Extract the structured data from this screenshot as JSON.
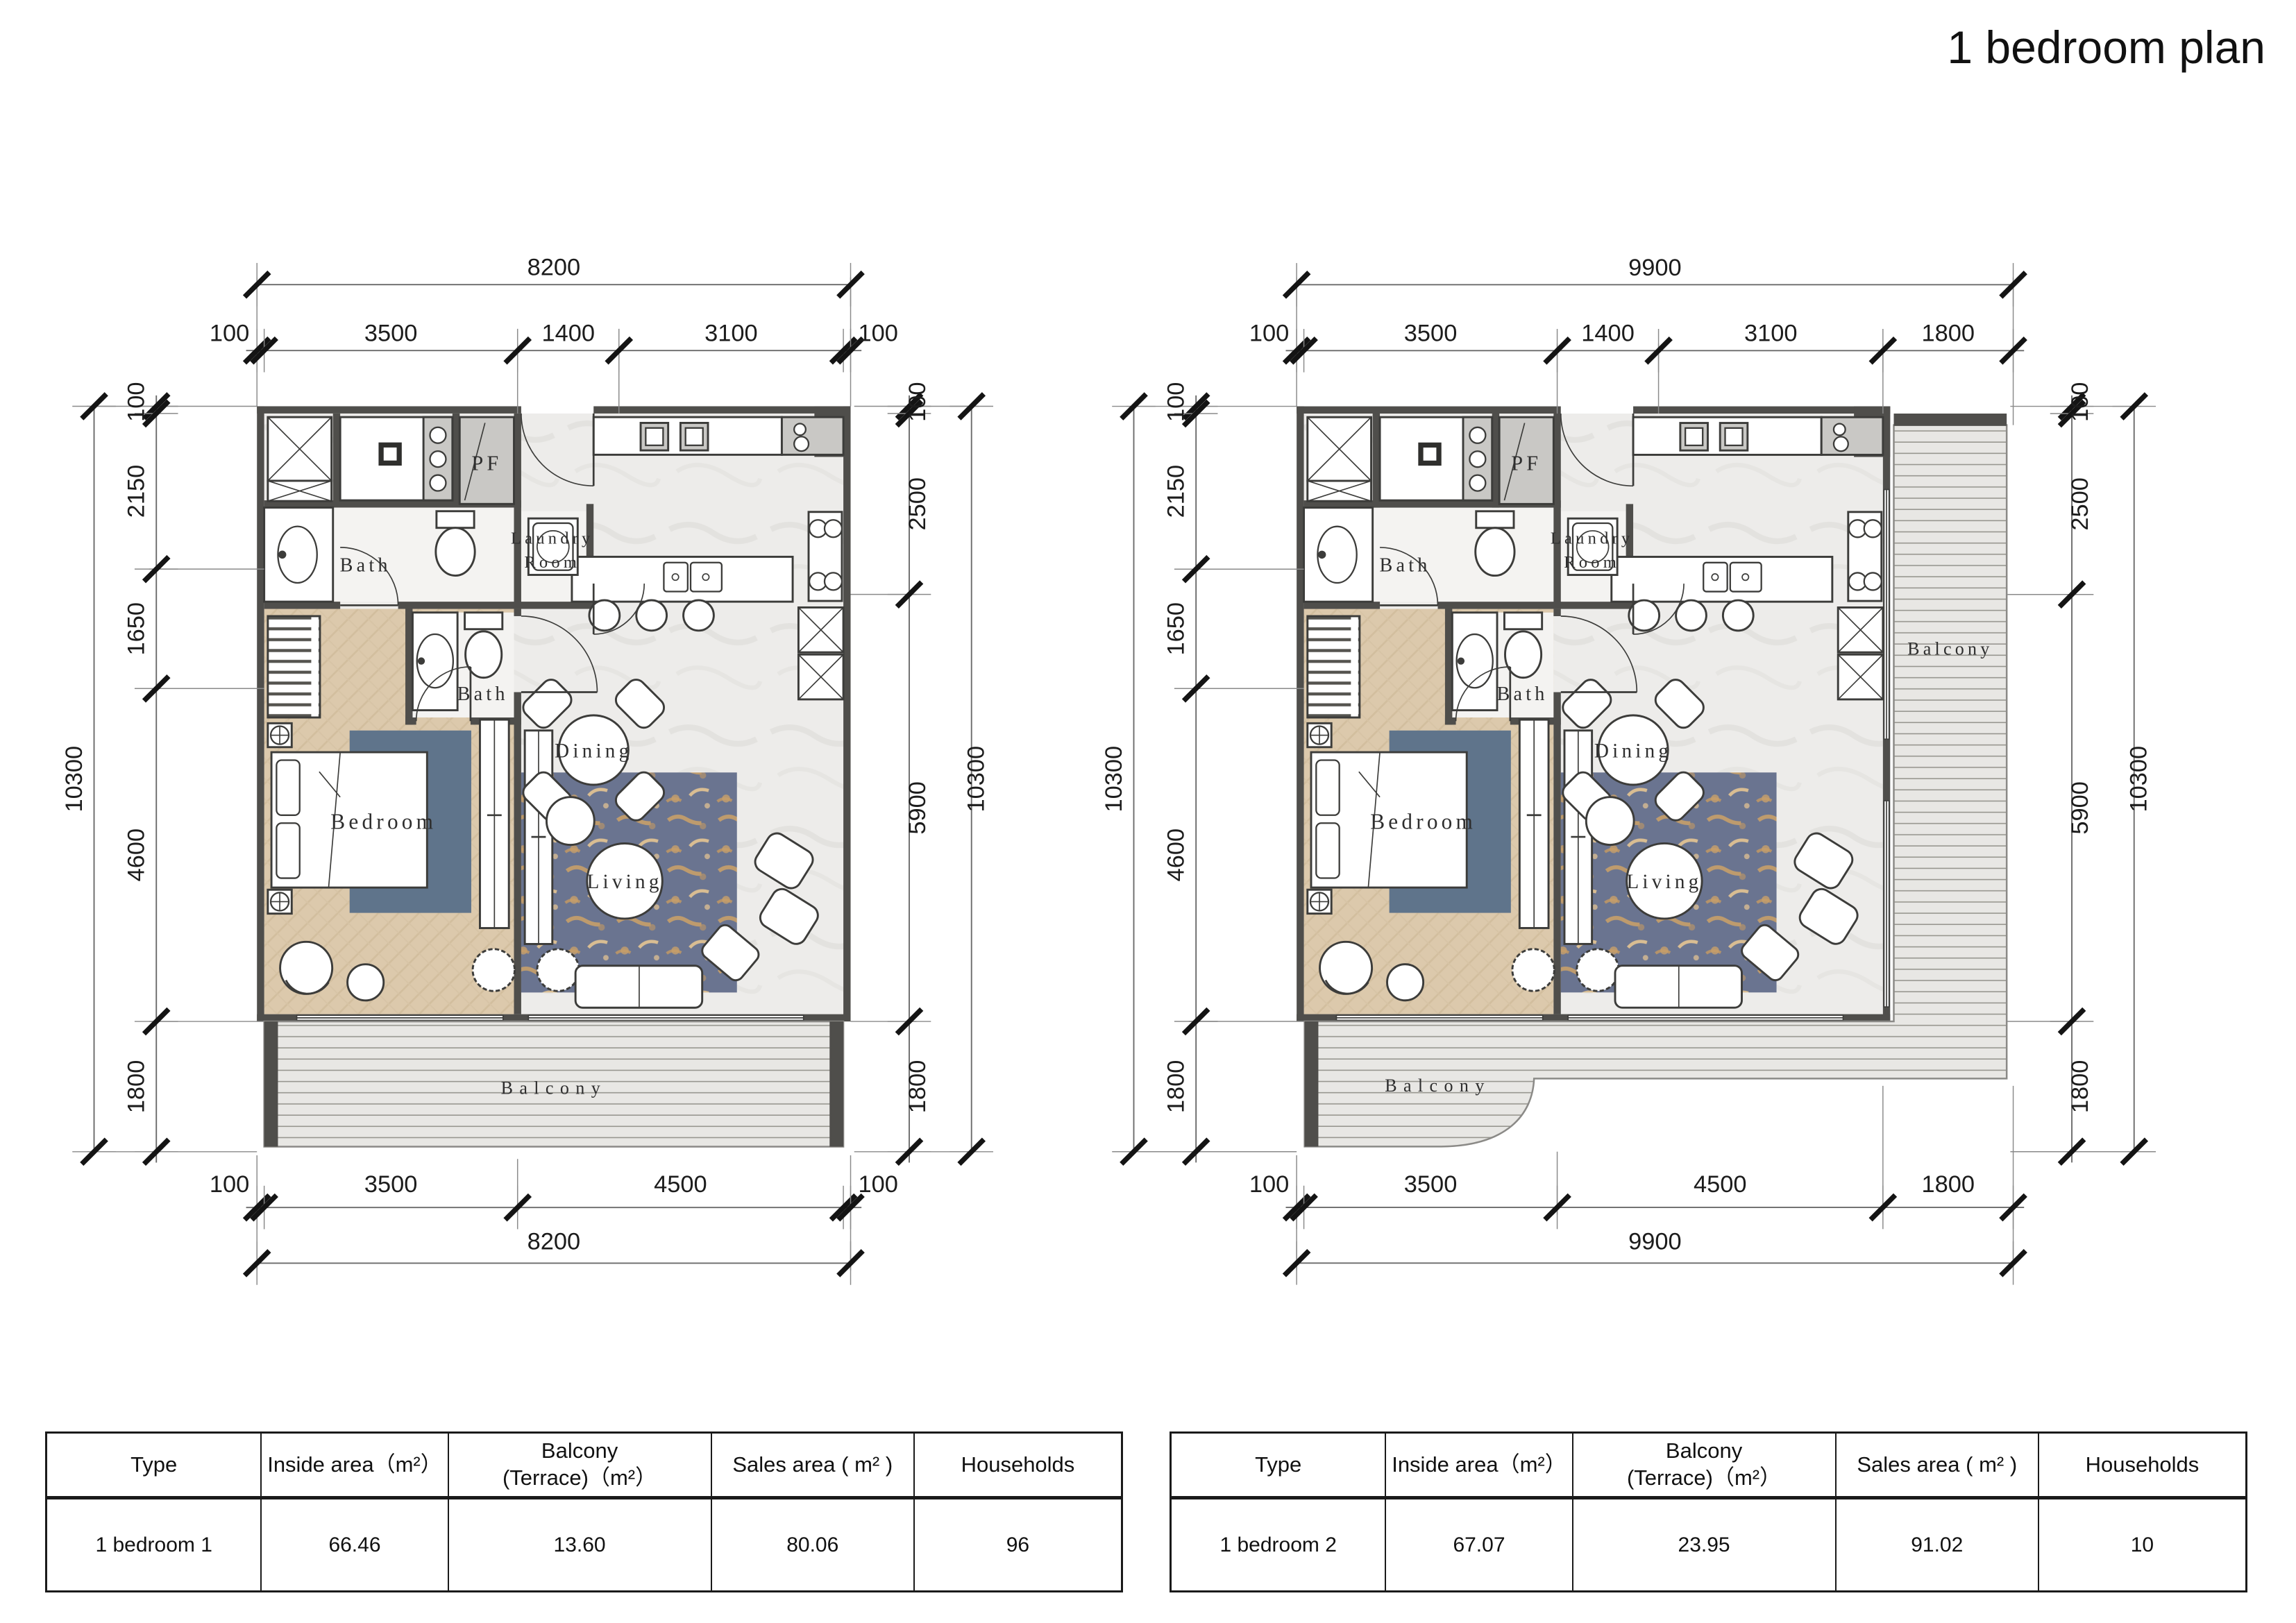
{
  "title": "1 bedroom plan",
  "colors": {
    "wall": "#4f4e4b",
    "bedroom_floor": "#dcc9ac",
    "marble_floor": "#edecea",
    "rug_bedroom": "#5f748b",
    "rug_living": "#6a7490",
    "rug_gold": "#c8a06a",
    "balcony_bg": "#e8e7e4"
  },
  "plan_left": {
    "name": "1 bedroom 1 floor plan",
    "labels": {
      "bath_upper": "Bath",
      "bath_lower": "Bath",
      "laundry_1": "Laundry",
      "laundry_2": "Room",
      "pf": "PF",
      "bedroom": "Bedroom",
      "dining": "Dining",
      "living": "Living",
      "balcony": "Balcony"
    },
    "dims": {
      "top_total": "8200",
      "top_segs": [
        "100",
        "3500",
        "1400",
        "3100",
        "100"
      ],
      "bottom_segs": [
        "100",
        "3500",
        "4500",
        "100"
      ],
      "bottom_total": "8200",
      "left_total": "10300",
      "left_segs": [
        "100",
        "2150",
        "1650",
        "4600",
        "1800"
      ],
      "right_segs": [
        "100",
        "2500",
        "5900",
        "1800"
      ],
      "right_total": "10300"
    }
  },
  "plan_right": {
    "name": "1 bedroom 2 floor plan",
    "labels": {
      "bath_upper": "Bath",
      "bath_lower": "Bath",
      "laundry_1": "Laundry",
      "laundry_2": "Room",
      "pf": "PF",
      "bedroom": "Bedroom",
      "dining": "Dining",
      "living": "Living",
      "balcony_side": "Balcony",
      "balcony": "Balcony"
    },
    "dims": {
      "top_total": "9900",
      "top_segs": [
        "100",
        "3500",
        "1400",
        "3100",
        "1800"
      ],
      "bottom_segs": [
        "100",
        "3500",
        "4500",
        "1800"
      ],
      "bottom_total": "9900",
      "left_total": "10300",
      "left_segs": [
        "100",
        "2150",
        "1650",
        "4600",
        "1800"
      ],
      "right_segs": [
        "100",
        "2500",
        "5900",
        "1800"
      ],
      "right_total": "10300"
    }
  },
  "tables": [
    {
      "headers": {
        "type": "Type",
        "inside": "Inside area（m²）",
        "balcony_l1": "Balcony",
        "balcony_l2": "(Terrace)（m²）",
        "sales": "Sales area ( m² )",
        "households": "Households"
      },
      "row": {
        "type": "1 bedroom 1",
        "inside": "66.46",
        "balcony": "13.60",
        "sales": "80.06",
        "households": "96"
      }
    },
    {
      "headers": {
        "type": "Type",
        "inside": "Inside area（m²）",
        "balcony_l1": "Balcony",
        "balcony_l2": "(Terrace)（m²）",
        "sales": "Sales area ( m² )",
        "households": "Households"
      },
      "row": {
        "type": "1 bedroom 2",
        "inside": "67.07",
        "balcony": "23.95",
        "sales": "91.02",
        "households": "10"
      }
    }
  ]
}
